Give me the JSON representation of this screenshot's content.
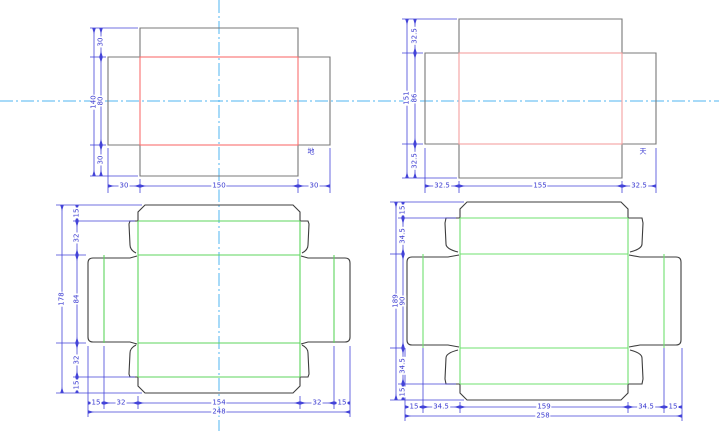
{
  "app": {
    "description_labels": {
      "base_part": "地",
      "lid_part": "天"
    }
  },
  "colors": {
    "background": "#ffffff",
    "outline_top_views": "#787878",
    "outline_dielines": "#3d3d3d",
    "crease_red_base": "#f87070",
    "crease_red_lid": "#f4a0a0",
    "crease_green": "#5cd65c",
    "dimension_blue": "#4343d8",
    "centerline_cyan": "#4fb6f0"
  },
  "drawings": {
    "base_view": {
      "part_label": "地",
      "dim_total_height": "140",
      "dim_top_flap": "30",
      "dim_panel_height": "80",
      "dim_bottom_flap": "30",
      "dim_left_flap": "30",
      "dim_panel_width": "150",
      "dim_right_flap": "30"
    },
    "lid_view": {
      "part_label": "天",
      "dim_total_height": "151",
      "dim_top_flap": "32.5",
      "dim_panel_height": "86",
      "dim_bottom_flap": "32.5",
      "dim_left_flap": "32.5",
      "dim_panel_width": "155",
      "dim_right_flap": "32.5"
    },
    "base_dieline": {
      "dim_total_height": "178",
      "dim_top_flap": "15",
      "dim_top_wall": "32",
      "dim_panel_height": "84",
      "dim_bottom_wall": "32",
      "dim_bottom_flap": "15",
      "dim_left_flap": "15",
      "dim_left_wall": "32",
      "dim_panel_width": "154",
      "dim_right_wall": "32",
      "dim_right_flap": "15",
      "dim_total_width": "248"
    },
    "lid_dieline": {
      "dim_total_height": "189",
      "dim_top_flap": "15",
      "dim_top_wall": "34.5",
      "dim_panel_height": "90",
      "dim_bottom_wall": "34.5",
      "dim_bottom_flap": "15",
      "dim_left_flap": "15",
      "dim_left_wall": "34.5",
      "dim_panel_width": "159",
      "dim_right_wall": "34.5",
      "dim_right_flap": "15",
      "dim_total_width": "258"
    }
  }
}
